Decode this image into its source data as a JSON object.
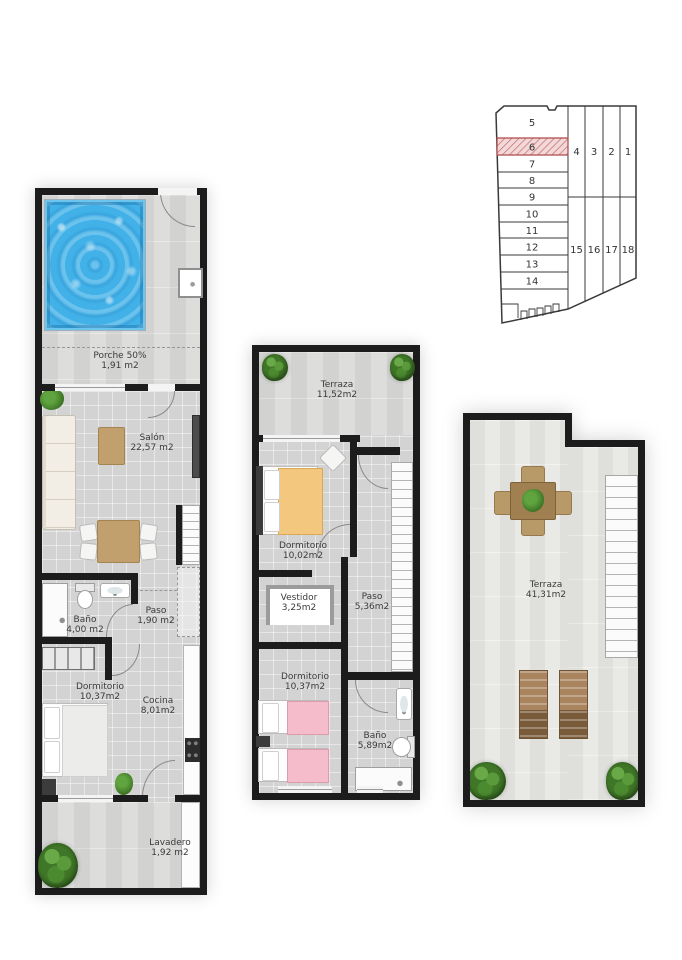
{
  "site_plan": {
    "plots_left": [
      "5",
      "6",
      "7",
      "8",
      "9",
      "10",
      "11",
      "12",
      "13",
      "14"
    ],
    "plots_right_top": [
      "4",
      "3",
      "2",
      "1"
    ],
    "plots_right_bottom": [
      "15",
      "16",
      "17",
      "18"
    ],
    "highlighted_plot": "6"
  },
  "ground_floor": {
    "porche": {
      "name": "Porche 50%",
      "area": "1,91 m2"
    },
    "salon": {
      "name": "Salón",
      "area": "22,57 m2"
    },
    "bano": {
      "name": "Baño",
      "area": "4,00 m2"
    },
    "paso": {
      "name": "Paso",
      "area": "1,90 m2"
    },
    "dormitorio": {
      "name": "Dormitorio",
      "area": "10,37m2"
    },
    "cocina": {
      "name": "Cocina",
      "area": "8,01m2"
    },
    "lavadero": {
      "name": "Lavadero",
      "area": "1,92 m2"
    }
  },
  "first_floor": {
    "terraza": {
      "name": "Terraza",
      "area": "11,52m2"
    },
    "dormitorio_principal": {
      "name": "Dormitorio",
      "area": "10,02m2"
    },
    "vestidor": {
      "name": "Vestidor",
      "area": "3,25m2"
    },
    "paso": {
      "name": "Paso",
      "area": "5,36m2"
    },
    "dormitorio_doble": {
      "name": "Dormitorio",
      "area": "10,37m2"
    },
    "bano": {
      "name": "Baño",
      "area": "5,89m2"
    }
  },
  "solarium": {
    "terraza": {
      "name": "Terraza",
      "area": "41,31m2"
    }
  },
  "colors": {
    "pool_blue": "#41b1e8",
    "plot_highlight_fill": "#f2d8d8",
    "plot_highlight_stroke": "#b05050",
    "bed_orange": "#f3c77e",
    "bed_pink": "#f5bccb",
    "wall_black": "#1c1c1c"
  }
}
